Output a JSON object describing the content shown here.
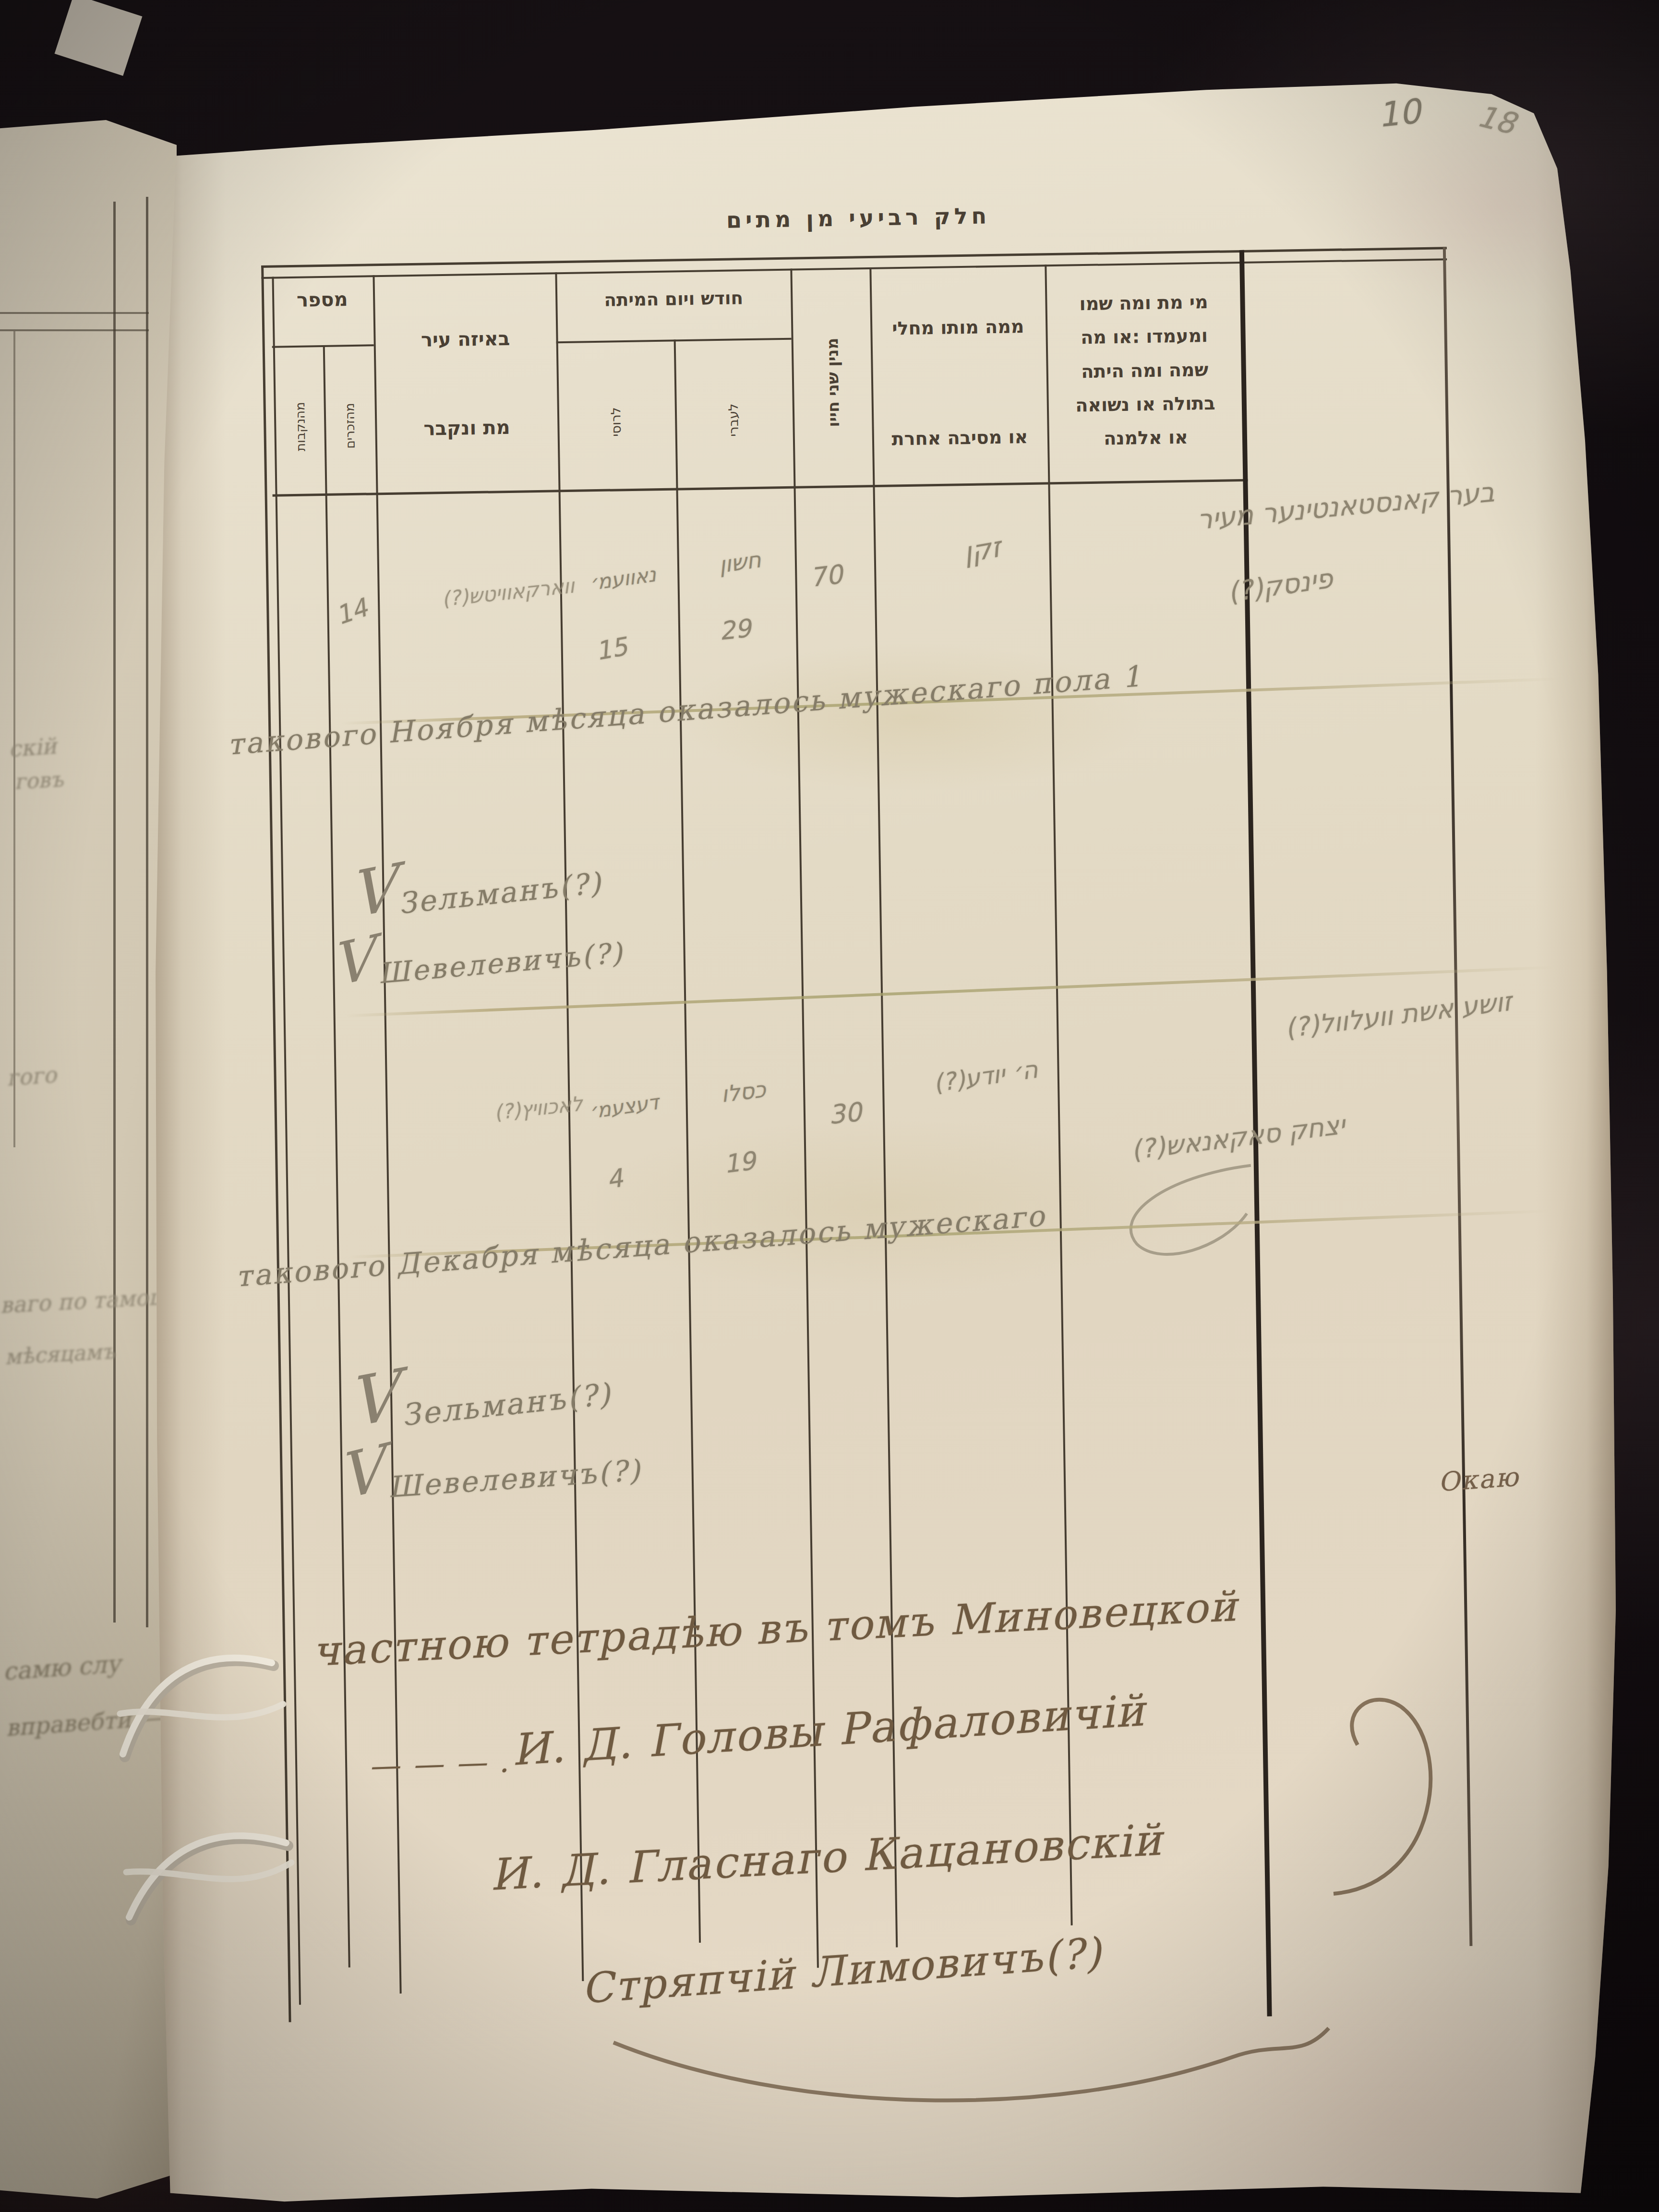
{
  "page": {
    "corner_number_primary": "10",
    "corner_number_secondary": "18",
    "catchword": "\u041e\u043a\u0430\u044e",
    "title": "\u05d7\u05dc\u05e7 \u05e8\u05d1\u05d9\u05e2\u05d9 \u05de\u05df \u05de\u05ea\u05d9\u05dd"
  },
  "table": {
    "columns": {
      "number": {
        "label": "\u05de\u05e1\u05e4\u05e8",
        "sub_right": "\u05de\u05d4\u05d6\u05db\u05e8\u05d9\u05dd",
        "sub_left": "\u05de\u05d4\u05e0\u05e7\u05d1\u05d5\u05ea"
      },
      "city": {
        "line1": "\u05d1\u05d0\u05d9\u05d6\u05d4 \u05e2\u05d9\u05e8",
        "line2": "\u05de\u05ea \u05d5\u05e0\u05e7\u05d1\u05e8"
      },
      "date": {
        "label": "\u05d7\u05d5\u05d3\u05e9 \u05d5\u05d9\u05d5\u05dd \u05d4\u05de\u05d9\u05ea\u05d4",
        "sub_right": "\u05dc\u05e2\u05d1\u05e8\u05d9",
        "sub_left": "\u05dc\u05e8\u05d5\u05e1\u05d9"
      },
      "age": {
        "label": "\u05de\u05e0\u05d9\u05df \u05e9\u05e0\u05d9 \u05d7\u05d9\u05d9\u05d5"
      },
      "cause": {
        "line1": "\u05de\u05de\u05d4 \u05de\u05d5\u05ea\u05d5 \u05de\u05d7\u05dc\u05d9",
        "line2": "\u05d0\u05d5 \u05de\u05e1\u05d9\u05d1\u05d4 \u05d0\u05d7\u05e8\u05ea"
      },
      "name": {
        "line1": "\u05de\u05d9 \u05de\u05ea \u05d5\u05de\u05d4 \u05e9\u05de\u05d5",
        "line2": "\u05d5\u05de\u05e2\u05de\u05d3\u05d5 :\u05d0\u05d5 \u05de\u05d4",
        "line3": "\u05e9\u05de\u05d4 \u05d5\u05de\u05d4 \u05d4\u05d9\u05ea\u05d4",
        "line4": "\u05d1\u05ea\u05d5\u05dc\u05d4 \u05d0\u05d5 \u05e0\u05e9\u05d5\u05d0\u05d4",
        "line5": "\u05d0\u05d5 \u05d0\u05dc\u05de\u05e0\u05d4"
      }
    }
  },
  "entries": [
    {
      "number_male": "14",
      "city": "\u05d5\u05d5\u05d0\u05e8\u05e7\u05d0\u05d5\u05d5\u05d9\u05d8\u05e9(?)",
      "date_hebrew_month": "\u05d7\u05e9\u05d5\u05df",
      "date_hebrew_day": "29",
      "date_russian_month": "\u05e0\u05d0\u05d5\u05d5\u05e2\u05de\u05f3",
      "date_russian_day": "15",
      "age": "70",
      "cause": "\u05d6\u05e7\u05df",
      "name_line1": "\u05d1\u05e2\u05e8 \u05e7\u05d0\u05e0\u05e1\u05d8\u05d0\u05e0\u05d8\u05d9\u05e0\u05e2\u05e8 \u05de\u05e2\u05d9\u05e8",
      "name_line2": "\u05e4\u05d9\u05e0\u05e1\u05e7(?)"
    },
    {
      "number_male": "",
      "city": "\u05dc\u05d0\u05db\u05d5\u05d5\u05d9\u05e5(?)",
      "date_hebrew_month": "\u05db\u05e1\u05dc\u05d5",
      "date_hebrew_day": "19",
      "date_russian_month": "\u05d3\u05e2\u05e6\u05e2\u05de\u05f3",
      "date_russian_day": "4",
      "age": "30",
      "cause": "\u05d4\u05f3 \u05d9\u05d5\u05d3\u05e2(?)",
      "name_line1": "\u05d6\u05d5\u05e9\u05e2 \u05d0\u05e9\u05ea \u05d5\u05d5\u05e2\u05dc\u05d5\u05d5\u05dc(?)",
      "name_line2": "\u05d9\u05e6\u05d7\u05e7 \u05e1\u05d0\u05e7\u05d0\u05e0\u05d0\u05e9(?)"
    }
  ],
  "summaries": [
    "\u0442\u0430\u043a\u043e\u0432\u043e\u0433\u043e \u041d\u043e\u044f\u0431\u0440\u044f \u043c\u0463\u0441\u044f\u0446\u0430 \u043e\u043a\u0430\u0437\u0430\u043b\u043e\u0441\u044c \u043c\u0443\u0436\u0435\u0441\u043a\u0430\u0433\u043e \u043f\u043e\u043b\u0430 1",
    "\u0442\u0430\u043a\u043e\u0432\u043e\u0433\u043e \u0414\u0435\u043a\u0430\u0431\u0440\u044f \u043c\u0463\u0441\u044f\u0446\u0430 \u043e\u043a\u0430\u0437\u0430\u043b\u043e\u0441\u044c \u043c\u0443\u0436\u0435\u0441\u043a\u0430\u0433\u043e"
  ],
  "verifications": [
    {
      "line1": "\u0417\u0435\u043b\u044c\u043c\u0430\u043d\u044a(?)",
      "line2": "\u0428\u0435\u0432\u0435\u043b\u0435\u0432\u0438\u0447\u044a(?)"
    },
    {
      "line1": "\u0417\u0435\u043b\u044c\u043c\u0430\u043d\u044a(?)",
      "line2": "\u0428\u0435\u0432\u0435\u043b\u0435\u0432\u0438\u0447\u044a(?)"
    }
  ],
  "signatures": {
    "line1": "\u0447\u0430\u0441\u0442\u043d\u043e\u044e \u0442\u0435\u0442\u0440\u0430\u0434\u0463\u044e \u0432\u044a \u0442\u043e\u043c\u044a \u041c\u0438\u043d\u043e\u0432\u0435\u0446\u043a\u043e\u0439",
    "dashes": "\u2014 \u2014 \u2014 .",
    "line2": "\u0418. \u0414. \u0413\u043e\u043b\u043e\u0432\u044b \u0420\u0430\u0444\u0430\u043b\u043e\u0432\u0438\u0447\u0456\u0439",
    "line3": "\u0418. \u0414. \u0413\u043b\u0430\u0441\u043d\u0430\u0433\u043e \u041a\u0430\u0446\u0430\u043d\u043e\u0432\u0441\u043a\u0456\u0439",
    "line4": "\u0421\u0442\u0440\u044f\u043f\u0447\u0456\u0439 \u041b\u0438\u043c\u043e\u0432\u0438\u0447\u044a(?)"
  },
  "facing_page_fragments": [
    "\u0441\u043a\u0456\u0439",
    "\u0433\u043e\u0432\u044a",
    "\u0433\u043e\u0433\u043e",
    "\u0432\u0430\u0433\u043e \u043f\u043e \u0442\u0430\u043c\u043e\u0448\u043d\u044f\u0433\u043e",
    "\u043c\u0463\u0441\u044f\u0446\u0430\u043c\u044a",
    "\u0441\u0430\u043c\u044e \u0441\u043b\u0443",
    "\u0432\u043f\u0440\u0430\u0432\u0435\u0431\u0442\u0438 \u2014"
  ]
}
